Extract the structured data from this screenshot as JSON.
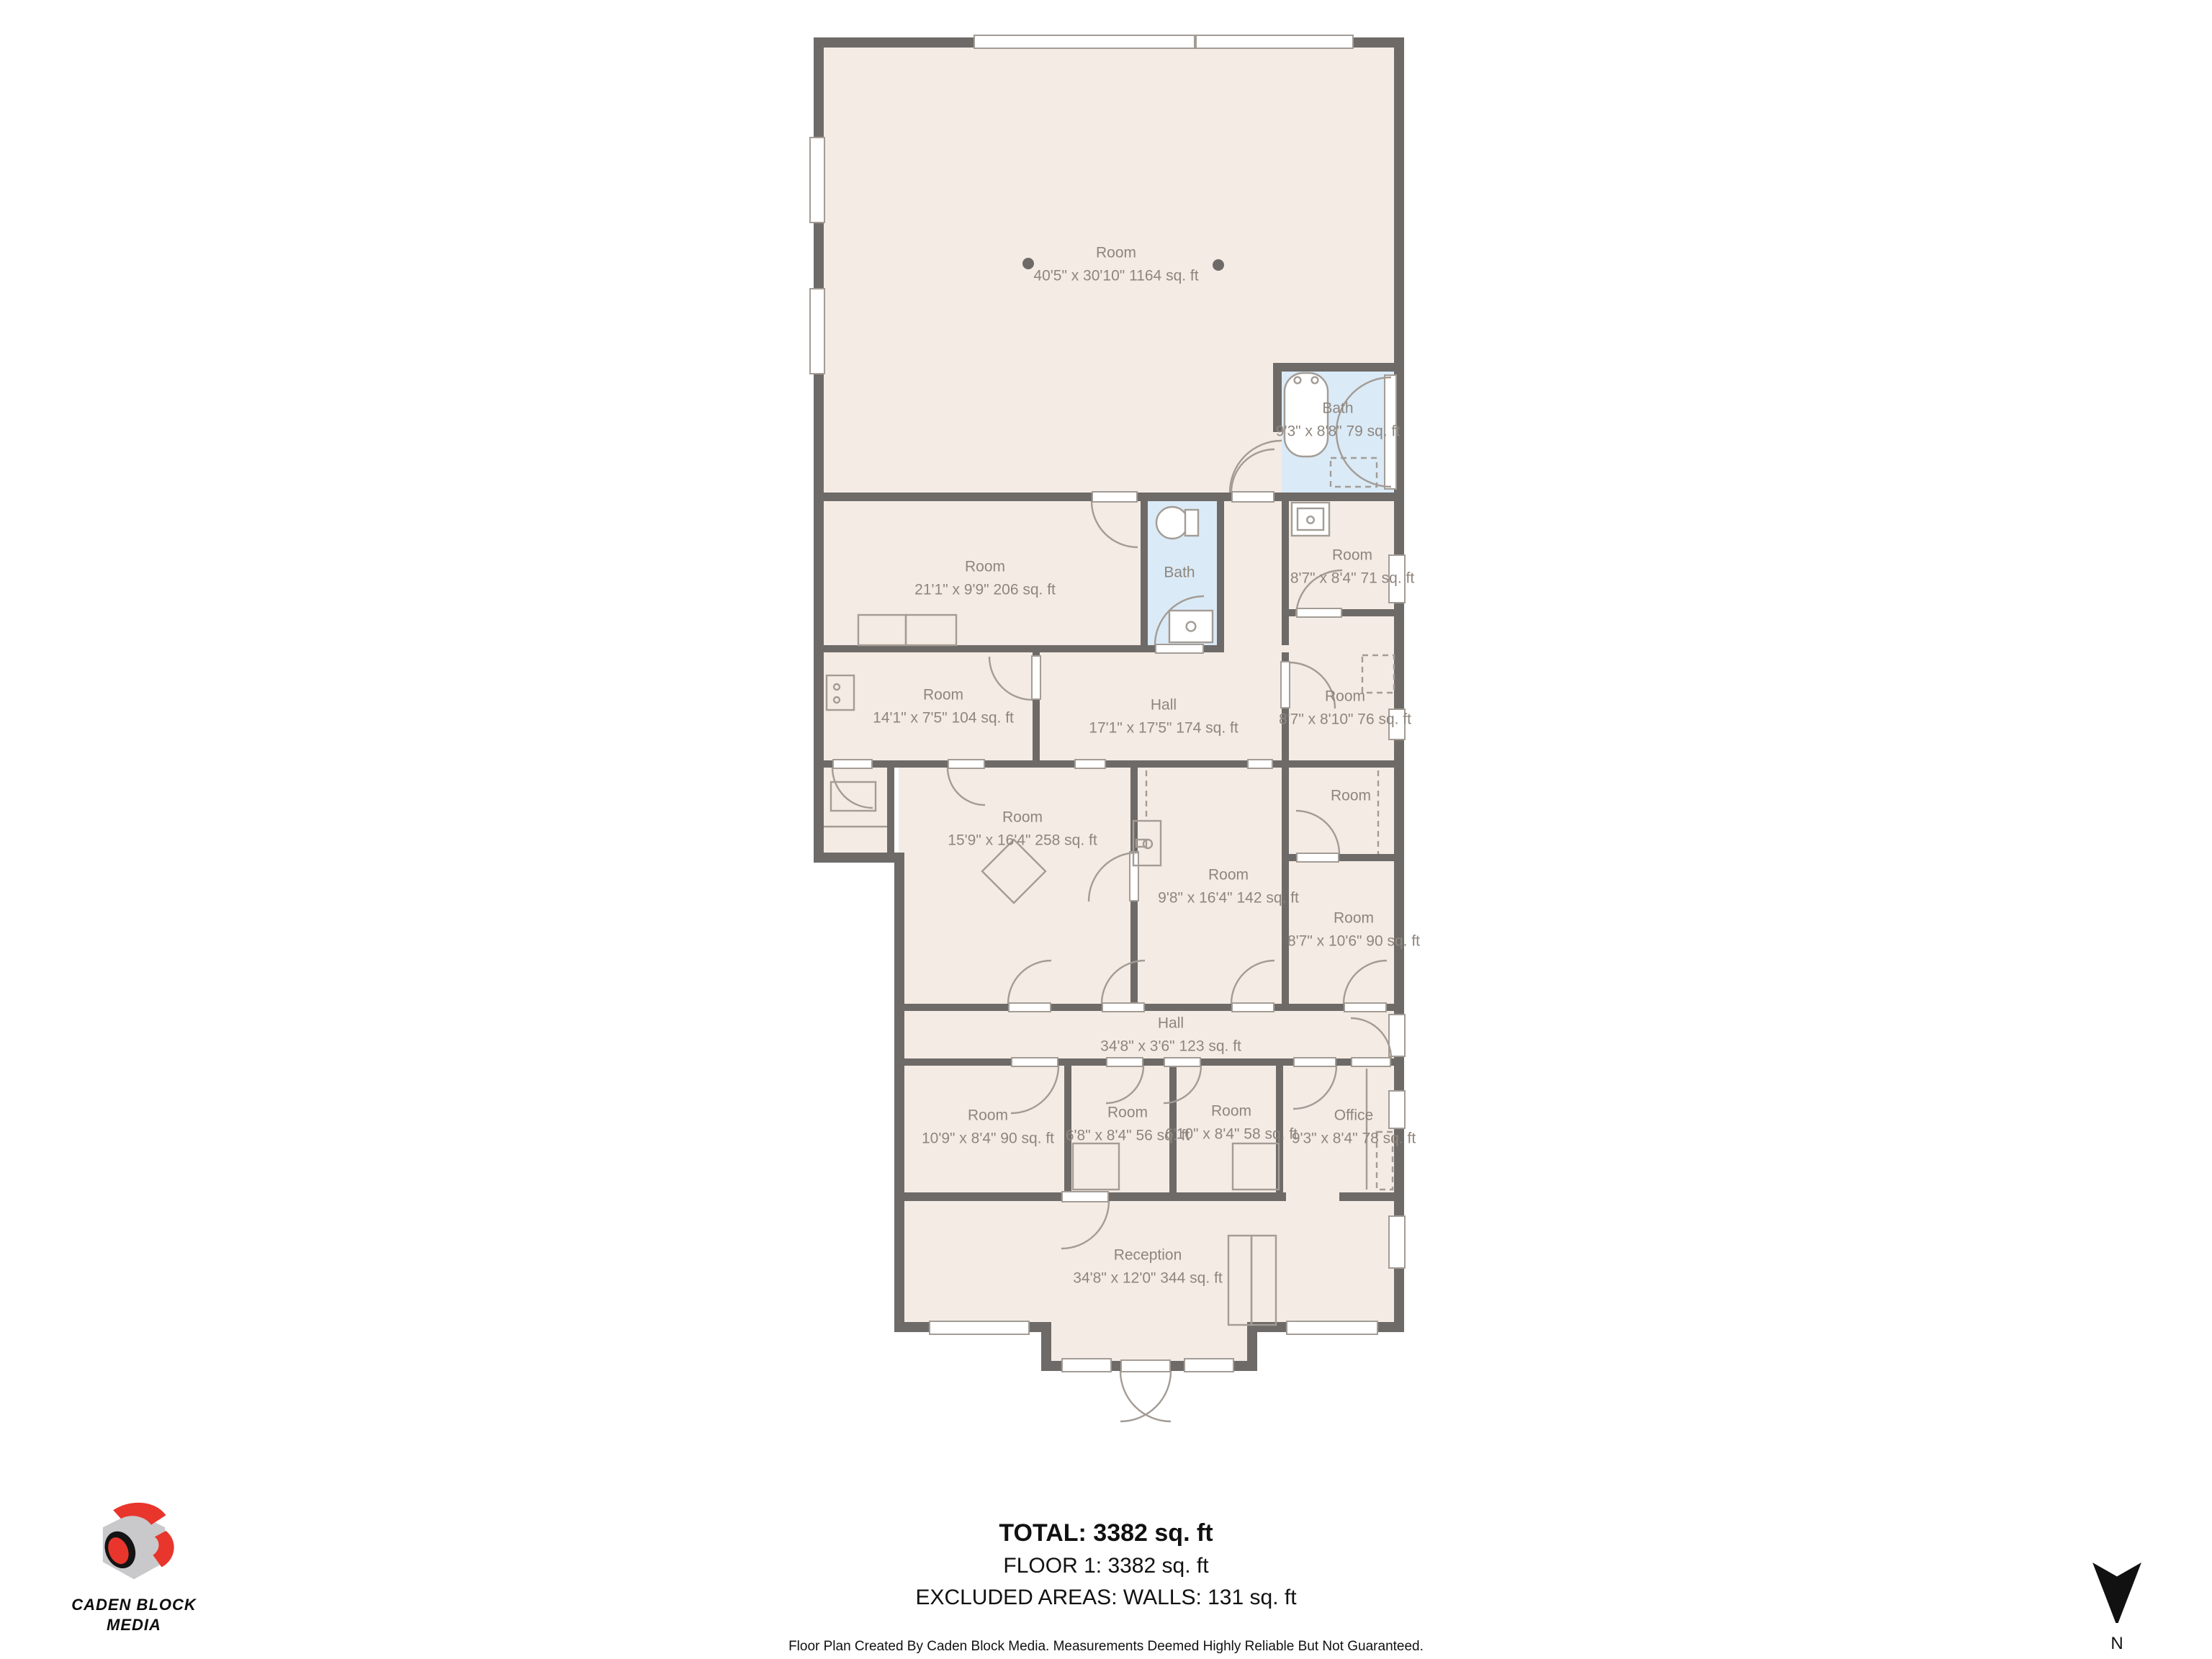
{
  "plan": {
    "title": "Floor plan",
    "wall_color": "#6e6a67",
    "floor_color": "#f4ebe5",
    "bath_color": "#daeaf7",
    "label_color": "#8e867e",
    "rooms": [
      {
        "name": "Room",
        "dims": "40'5\" x 30'10\" 1164 sq. ft"
      },
      {
        "name": "Bath",
        "dims": "9'3\" x 8'8\" 79 sq. ft"
      },
      {
        "name": "Room",
        "dims": "21'1\" x 9'9\" 206 sq. ft"
      },
      {
        "name": "Bath",
        "dims": ""
      },
      {
        "name": "Room",
        "dims": "8'7\" x 8'4\" 71 sq. ft"
      },
      {
        "name": "Room",
        "dims": "14'1\" x 7'5\" 104 sq. ft"
      },
      {
        "name": "Hall",
        "dims": "17'1\" x 17'5\" 174 sq. ft"
      },
      {
        "name": "Room",
        "dims": "8'7\" x 8'10\" 76 sq. ft"
      },
      {
        "name": "Room",
        "dims": "15'9\" x 16'4\" 258 sq. ft"
      },
      {
        "name": "Room",
        "dims": "9'8\" x 16'4\" 142 sq. ft"
      },
      {
        "name": "Room",
        "dims": ""
      },
      {
        "name": "Room",
        "dims": "8'7\" x 10'6\" 90 sq. ft"
      },
      {
        "name": "Hall",
        "dims": "34'8\" x 3'6\" 123 sq. ft"
      },
      {
        "name": "Room",
        "dims": "10'9\" x 8'4\" 90 sq. ft"
      },
      {
        "name": "Room",
        "dims": "6'8\" x 8'4\" 56 sq. ft"
      },
      {
        "name": "Room",
        "dims": "6'10\" x 8'4\" 58 sq. ft"
      },
      {
        "name": "Office",
        "dims": "9'3\" x 8'4\" 78 sq. ft"
      },
      {
        "name": "Reception",
        "dims": "34'8\" x 12'0\" 344 sq. ft"
      }
    ]
  },
  "footer": {
    "total": "TOTAL: 3382 sq. ft",
    "floor": "FLOOR 1: 3382 sq. ft",
    "excluded": "EXCLUDED AREAS: WALLS: 131 sq. ft",
    "disclaimer": "Floor Plan Created By Caden Block Media. Measurements Deemed Highly Reliable But Not Guaranteed."
  },
  "logo": {
    "line1": "CADEN BLOCK",
    "line2": "MEDIA",
    "red": "#e8362d",
    "gray": "#c9c9cb"
  },
  "compass": {
    "label": "N"
  }
}
